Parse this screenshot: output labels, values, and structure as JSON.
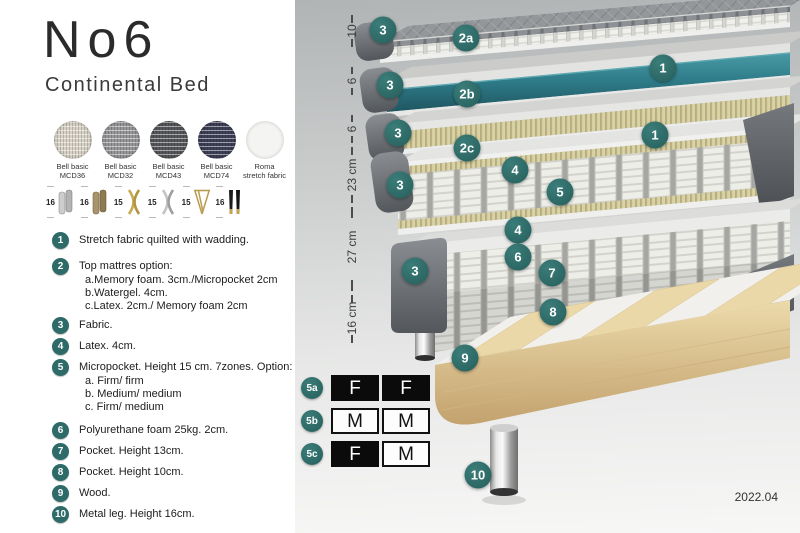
{
  "title": "No6",
  "subtitle": "Continental Bed",
  "swatches": [
    {
      "name": "Bell basic",
      "code": "MCD36"
    },
    {
      "name": "Bell basic",
      "code": "MCD32"
    },
    {
      "name": "Bell basic",
      "code": "MCD43"
    },
    {
      "name": "Bell basic",
      "code": "MCD74"
    },
    {
      "name": "Roma",
      "code": "stretch fabric"
    }
  ],
  "leg_options": [
    {
      "height": "16",
      "style": "cylinder-silver"
    },
    {
      "height": "16",
      "style": "cylinder-bronze"
    },
    {
      "height": "15",
      "style": "cross-gold"
    },
    {
      "height": "15",
      "style": "cross-silver"
    },
    {
      "height": "15",
      "style": "hairpin-gold"
    },
    {
      "height": "16",
      "style": "tapered-black-gold"
    }
  ],
  "list": [
    {
      "num": "1",
      "text": "Stretch fabric quilted with wadding."
    },
    {
      "num": "2",
      "text": "Top mattres option:",
      "sub": [
        "a.Memory foam. 3cm./Micropocket 2cm",
        "b.Watergel. 4cm.",
        "c.Latex. 2cm./ Memory foam 2cm"
      ]
    },
    {
      "num": "3",
      "text": "Fabric."
    },
    {
      "num": "4",
      "text": "Latex. 4cm."
    },
    {
      "num": "5",
      "text": "Micropocket. Height 15 cm. 7zones. Option:",
      "sub": [
        "a. Firm/ firm",
        "b. Medium/ medium",
        "c. Firm/ medium"
      ]
    },
    {
      "num": "6",
      "text": "Polyurethane foam 25kg. 2cm."
    },
    {
      "num": "7",
      "text": "Pocket. Height 13cm."
    },
    {
      "num": "8",
      "text": "Pocket. Height 10cm."
    },
    {
      "num": "9",
      "text": "Wood."
    },
    {
      "num": "10",
      "text": "Metal leg. Height 16cm."
    }
  ],
  "diagram": {
    "dims": [
      "10",
      "6",
      "6",
      "23 cm",
      "27 cm",
      "16 cm"
    ],
    "labels": {
      "1": "1",
      "2a": "2a",
      "2b": "2b",
      "2c": "2c",
      "3": "3",
      "4": "4",
      "5": "5",
      "6": "6",
      "7": "7",
      "8": "8",
      "9": "9",
      "10": "10"
    },
    "firmness": [
      {
        "label": "5a",
        "left": "F",
        "right": "F",
        "left_bg": "black",
        "right_bg": "black"
      },
      {
        "label": "5b",
        "left": "M",
        "right": "M",
        "left_bg": "white",
        "right_bg": "white"
      },
      {
        "label": "5c",
        "left": "F",
        "right": "M",
        "left_bg": "black",
        "right_bg": "white"
      }
    ],
    "version": "2022.04"
  },
  "colors": {
    "badge_teal": "#2e6b68",
    "watergel_teal": "#2f7d8a",
    "latex_tan": "#d9d2a4",
    "wood": "#decb9c",
    "dark_fabric": "#5d6165"
  }
}
